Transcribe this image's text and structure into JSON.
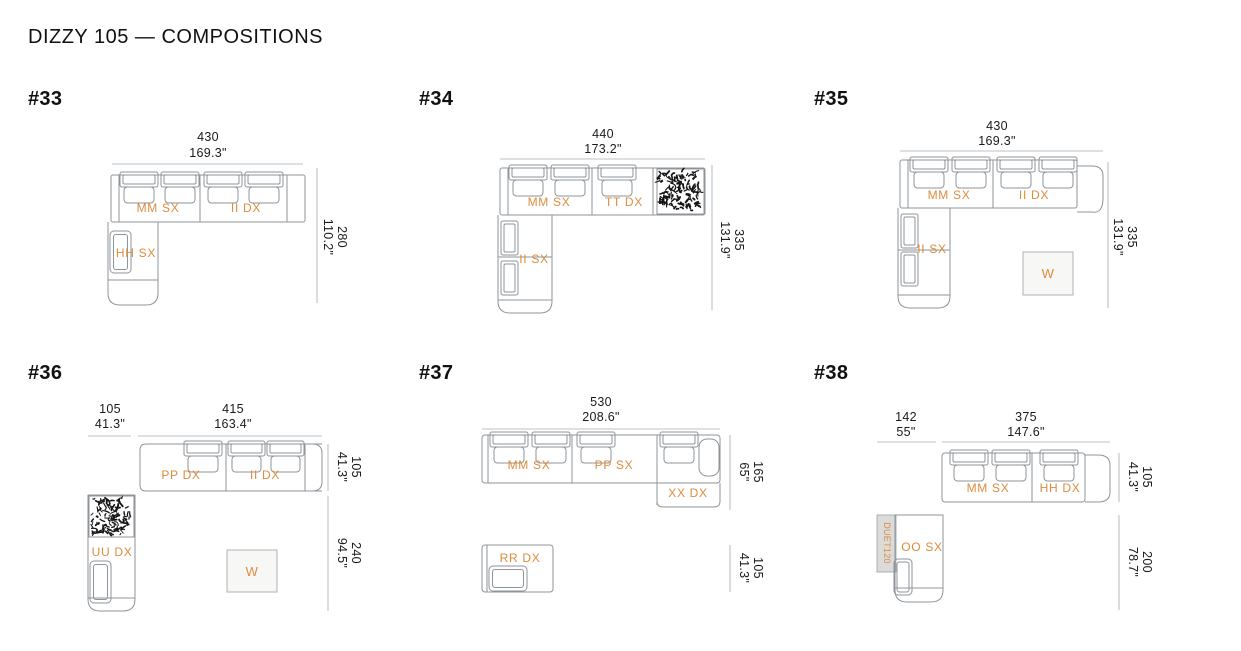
{
  "page": {
    "title": "DIZZY 105 — COMPOSITIONS"
  },
  "colors": {
    "accent_orange": "#DD8C3C",
    "furniture_line": "#8F949A",
    "dimension_line": "#BCC0C3",
    "text": "#1A1A1A",
    "strip_fill": "#DBDBD9",
    "texture_mark": "#161616"
  },
  "compositions": [
    {
      "id": "#33",
      "dims_top": [
        {
          "mm": "430",
          "inch": "169.3\""
        }
      ],
      "dims_right": [
        {
          "mm": "280",
          "inch": "110.2\""
        }
      ],
      "modules": [
        {
          "label": "MM SX"
        },
        {
          "label": "II DX"
        },
        {
          "label": "HH SX"
        }
      ]
    },
    {
      "id": "#34",
      "dims_top": [
        {
          "mm": "440",
          "inch": "173.2\""
        }
      ],
      "dims_right": [
        {
          "mm": "335",
          "inch": "131.9\""
        }
      ],
      "modules": [
        {
          "label": "MM SX"
        },
        {
          "label": "TT DX"
        },
        {
          "label": "II SX"
        }
      ]
    },
    {
      "id": "#35",
      "dims_top": [
        {
          "mm": "430",
          "inch": "169.3\""
        }
      ],
      "dims_right": [
        {
          "mm": "335",
          "inch": "131.9\""
        }
      ],
      "modules": [
        {
          "label": "MM SX"
        },
        {
          "label": "II DX"
        },
        {
          "label": "II SX"
        }
      ],
      "ottoman": {
        "label": "W"
      }
    },
    {
      "id": "#36",
      "dims_top": [
        {
          "mm": "105",
          "inch": "41.3\""
        },
        {
          "mm": "415",
          "inch": "163.4\""
        }
      ],
      "dims_right": [
        {
          "mm": "105",
          "inch": "41.3\""
        },
        {
          "mm": "240",
          "inch": "94.5\""
        }
      ],
      "modules": [
        {
          "label": "PP DX"
        },
        {
          "label": "II DX"
        },
        {
          "label": "UU DX"
        }
      ],
      "ottoman": {
        "label": "W"
      }
    },
    {
      "id": "#37",
      "dims_top": [
        {
          "mm": "530",
          "inch": "208.6\""
        }
      ],
      "dims_right": [
        {
          "mm": "165",
          "inch": "65\""
        },
        {
          "mm": "105",
          "inch": "41.3\""
        }
      ],
      "modules": [
        {
          "label": "MM SX"
        },
        {
          "label": "PP SX"
        },
        {
          "label": "XX DX"
        },
        {
          "label": "RR DX"
        }
      ]
    },
    {
      "id": "#38",
      "dims_top": [
        {
          "mm": "142",
          "inch": "55\""
        },
        {
          "mm": "375",
          "inch": "147.6\""
        }
      ],
      "dims_right": [
        {
          "mm": "105",
          "inch": "41.3\""
        },
        {
          "mm": "200",
          "inch": "78.7\""
        }
      ],
      "modules": [
        {
          "label": "MM SX"
        },
        {
          "label": "HH DX"
        },
        {
          "label": "OO SX"
        }
      ],
      "strip": {
        "label": "DUET120"
      }
    }
  ]
}
